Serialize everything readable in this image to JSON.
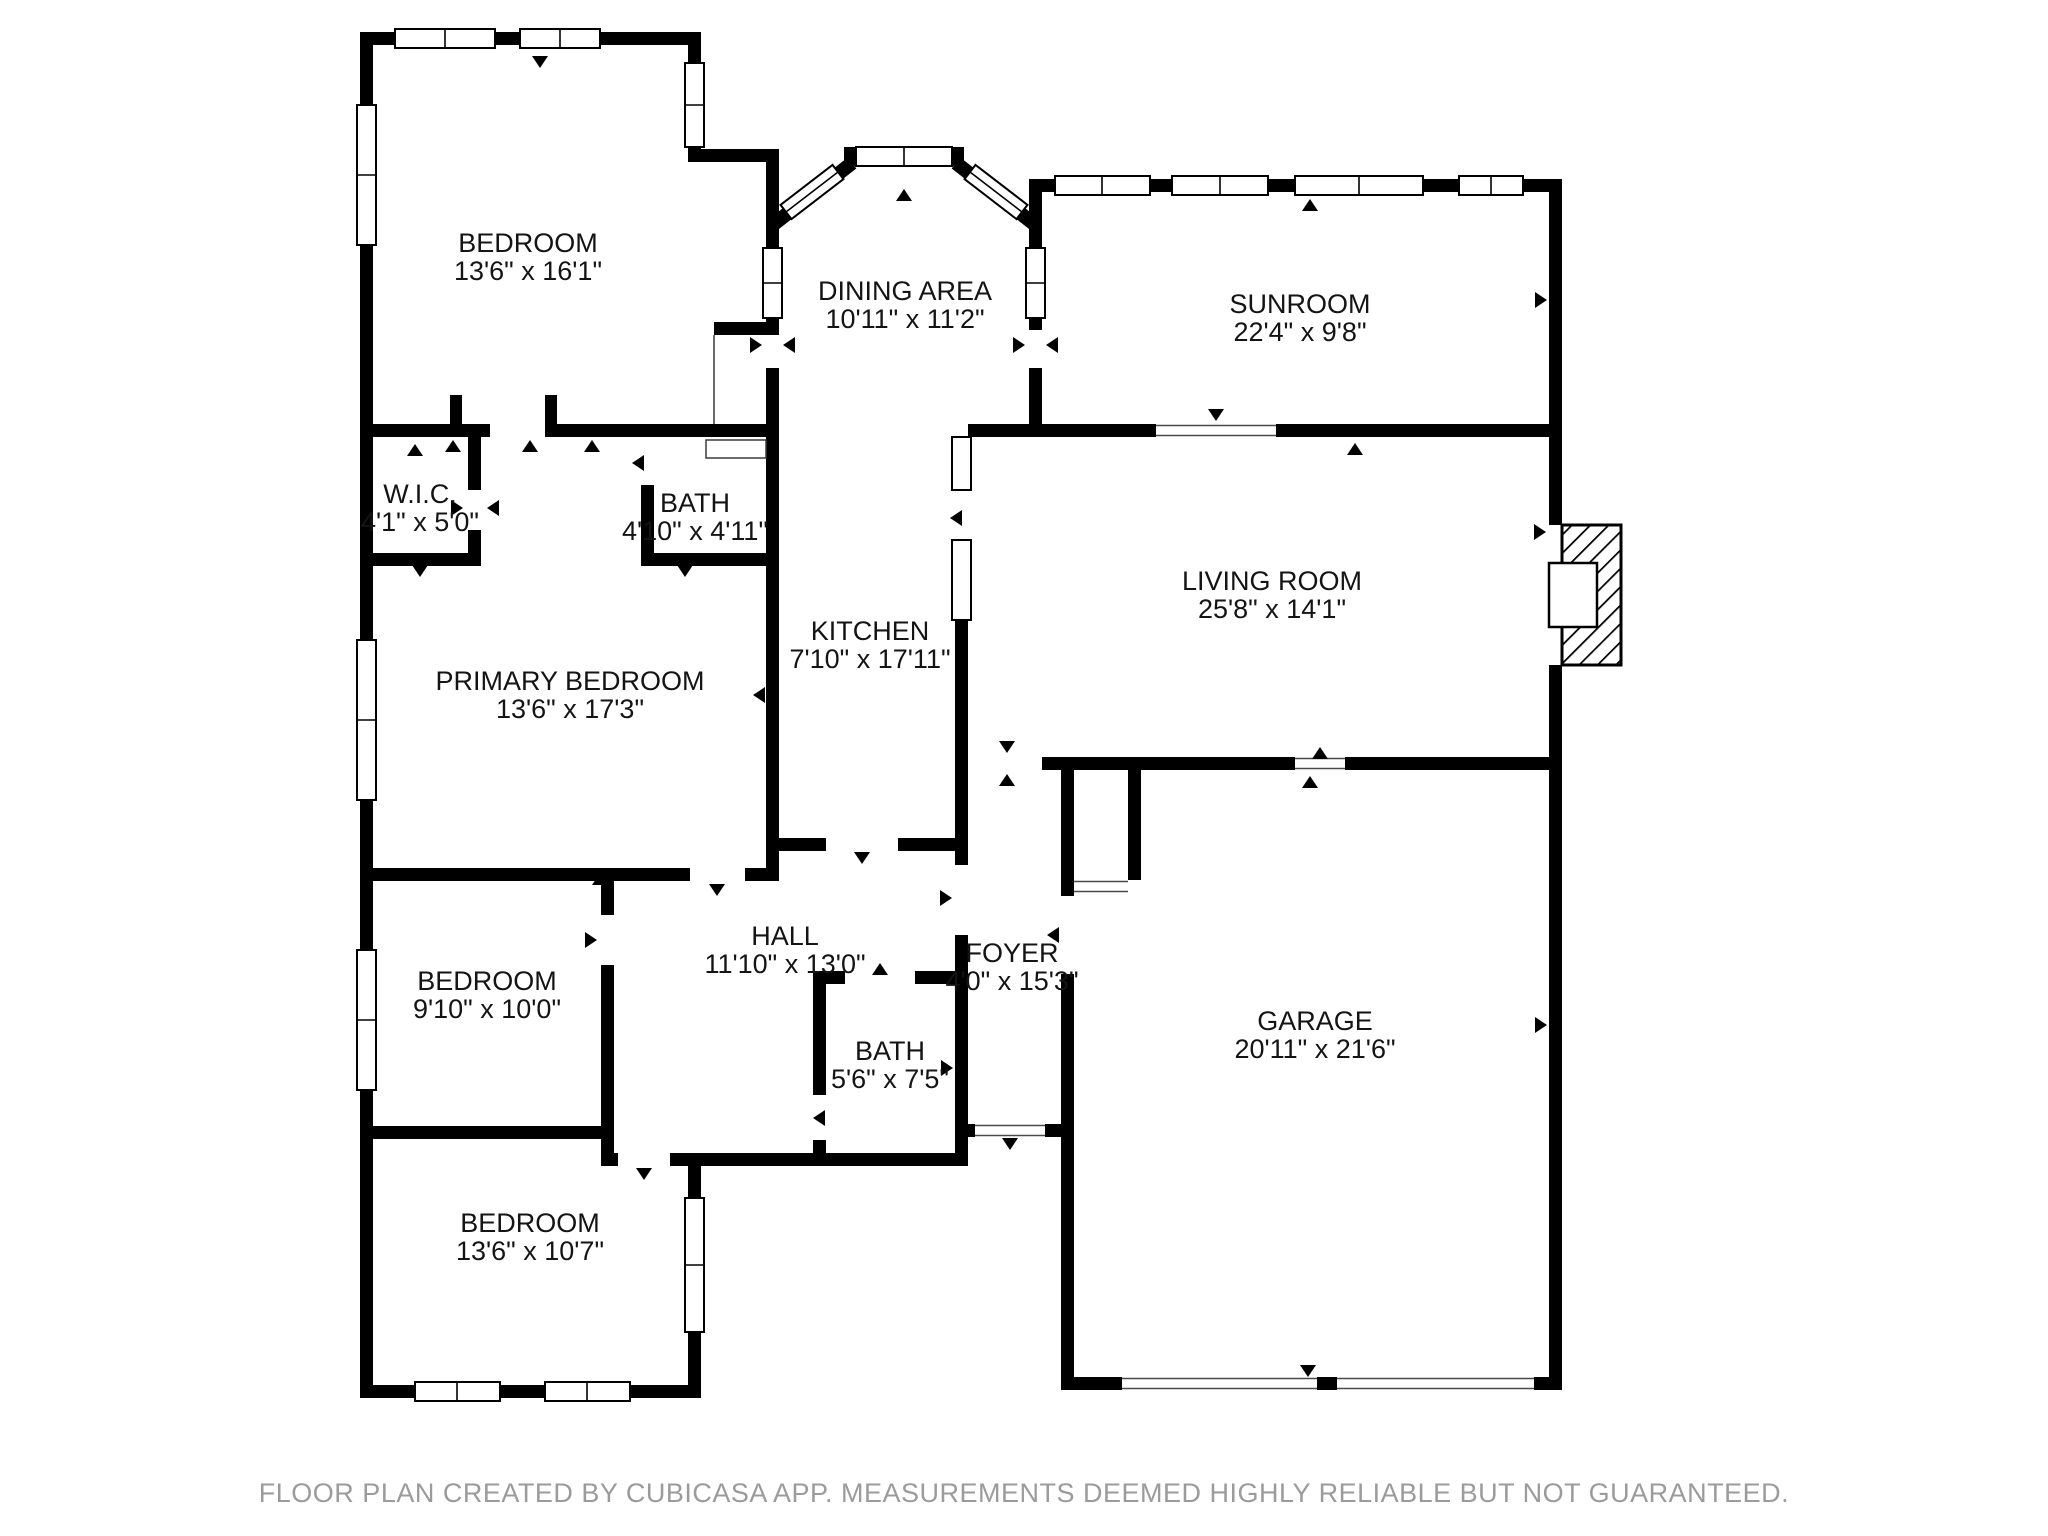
{
  "floor_plan": {
    "app_style": "cubicasa-black-white",
    "colors": {
      "wall": "#000000",
      "background": "#ffffff",
      "label_text": "#141414",
      "footer_text": "#9b9b9b"
    },
    "rooms": [
      {
        "id": "bedroom-top",
        "name": "BEDROOM",
        "dimensions": "13'6\" x 16'1\"",
        "x": 528,
        "y": 252
      },
      {
        "id": "dining-area",
        "name": "DINING AREA",
        "dimensions": "10'11\" x 11'2\"",
        "x": 905,
        "y": 300
      },
      {
        "id": "sunroom",
        "name": "SUNROOM",
        "dimensions": "22'4\" x 9'8\"",
        "x": 1300,
        "y": 313
      },
      {
        "id": "wic",
        "name": "W.I.C.",
        "dimensions": "4'1\" x 5'0\"",
        "x": 420,
        "y": 503
      },
      {
        "id": "bath-upper",
        "name": "BATH",
        "dimensions": "4'10\" x 4'11\"",
        "x": 695,
        "y": 512
      },
      {
        "id": "living-room",
        "name": "LIVING ROOM",
        "dimensions": "25'8\" x 14'1\"",
        "x": 1272,
        "y": 590
      },
      {
        "id": "kitchen",
        "name": "KITCHEN",
        "dimensions": "7'10\" x 17'11\"",
        "x": 870,
        "y": 640
      },
      {
        "id": "primary-bedroom",
        "name": "PRIMARY BEDROOM",
        "dimensions": "13'6\" x 17'3\"",
        "x": 570,
        "y": 690
      },
      {
        "id": "bedroom-middle",
        "name": "BEDROOM",
        "dimensions": "9'10\" x 10'0\"",
        "x": 487,
        "y": 990
      },
      {
        "id": "hall",
        "name": "HALL",
        "dimensions": "11'10\" x 13'0\"",
        "x": 785,
        "y": 945
      },
      {
        "id": "foyer",
        "name": "FOYER",
        "dimensions": "4'0\" x 15'3\"",
        "x": 1012,
        "y": 962
      },
      {
        "id": "bath-lower",
        "name": "BATH",
        "dimensions": "5'6\" x 7'5\"",
        "x": 890,
        "y": 1060
      },
      {
        "id": "garage",
        "name": "GARAGE",
        "dimensions": "20'11\" x 21'6\"",
        "x": 1315,
        "y": 1030
      },
      {
        "id": "bedroom-bottom",
        "name": "BEDROOM",
        "dimensions": "13'6\" x 10'7\"",
        "x": 530,
        "y": 1232
      }
    ],
    "footer": {
      "text": "FLOOR PLAN CREATED BY CUBICASA APP. MEASUREMENTS DEEMED HIGHLY RELIABLE BUT NOT GUARANTEED."
    }
  }
}
